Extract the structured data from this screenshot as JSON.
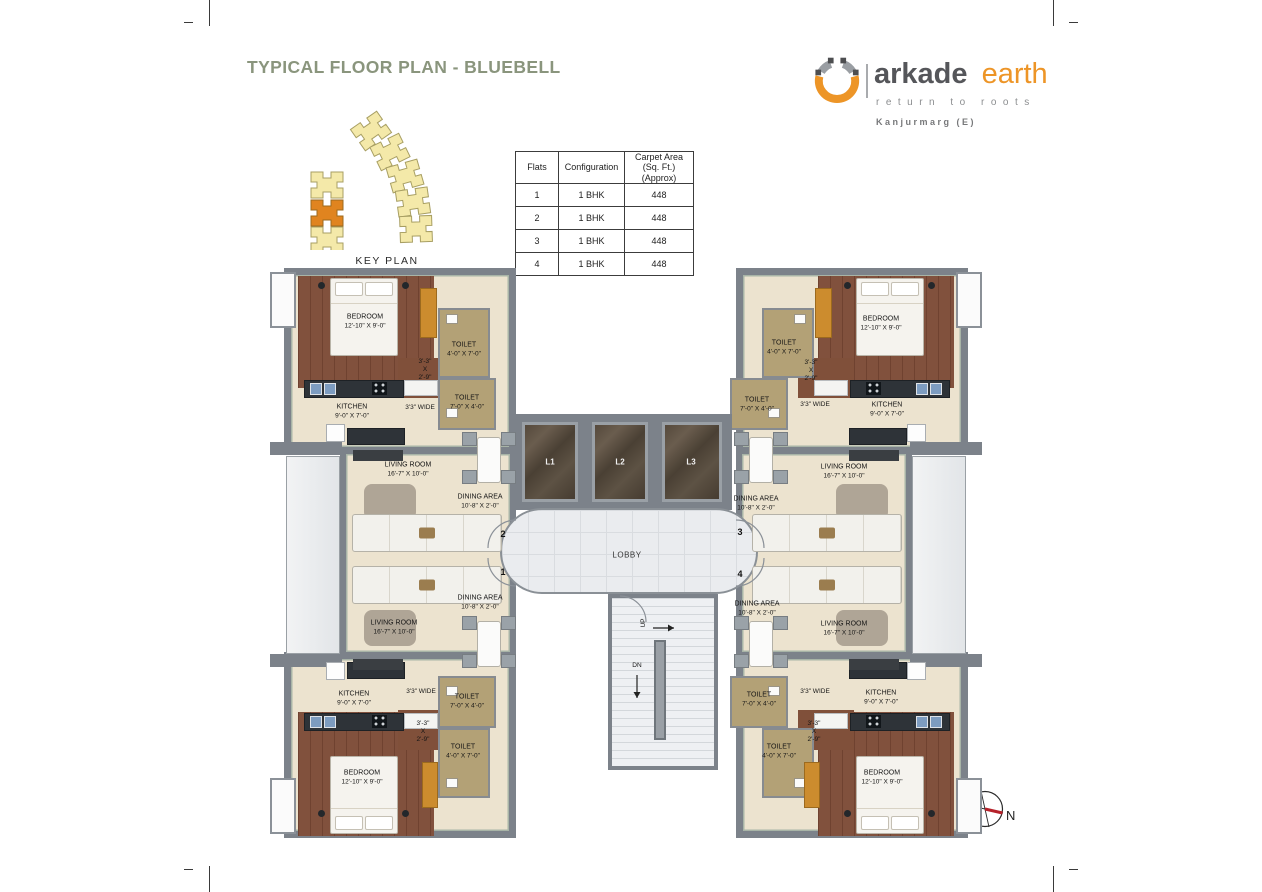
{
  "header": {
    "title": "TYPICAL FLOOR PLAN - BLUEBELL"
  },
  "logo": {
    "brand_primary": "arkade",
    "brand_secondary": "earth",
    "tagline": "return to roots",
    "location": "Kanjurmarg (E)"
  },
  "key_plan": {
    "label": "KEY PLAN"
  },
  "flats_table": {
    "headers": {
      "flats": "Flats",
      "configuration": "Configuration",
      "carpet_area_line1": "Carpet Area",
      "carpet_area_line2": "(Sq. Ft.) (Approx)"
    },
    "rows": [
      {
        "flat": "1",
        "config": "1 BHK",
        "area": "448"
      },
      {
        "flat": "2",
        "config": "1 BHK",
        "area": "448"
      },
      {
        "flat": "3",
        "config": "1 BHK",
        "area": "448"
      },
      {
        "flat": "4",
        "config": "1 BHK",
        "area": "448"
      }
    ]
  },
  "rooms": {
    "bedroom": {
      "name": "BEDROOM",
      "dim": "12'-10\" X 9'-0\""
    },
    "kitchen": {
      "name": "KITCHEN",
      "dim": "9'-0\" X 7'-0\""
    },
    "living_room": {
      "name": "LIVING ROOM",
      "dim": "16'-7\" X 10'-0\""
    },
    "dining_area": {
      "name": "DINING AREA",
      "dim": "10'-8\" X 2'-0\""
    },
    "toilet_v": {
      "name": "TOILET",
      "dim": "4'-0\" X 7'-0\""
    },
    "toilet_h": {
      "name": "TOILET",
      "dim": "7'-0\" X 4'-0\""
    },
    "passage": {
      "line1": "3'-3\"",
      "line2": "X",
      "line3": "2'-9\""
    },
    "corridor": {
      "dim": "3'3\" WIDE"
    }
  },
  "core": {
    "lifts": [
      "L1",
      "L2",
      "L3"
    ],
    "lobby": "LOBBY",
    "stair_up": "UP",
    "stair_down": "DN"
  },
  "flat_numbers": [
    "1",
    "2",
    "3",
    "4"
  ],
  "compass": {
    "north": "N"
  },
  "colors": {
    "title_green": "#8A957D",
    "accent_orange": "#ED9527",
    "wall_gray": "#7c828a",
    "bedroom_floor": "#7c4a35",
    "beige_floor": "#eae0cc",
    "toilet_floor": "#b3a176",
    "keyplan_yellow": "#f4e9a9",
    "keyplan_highlight": "#e0841f",
    "compass_needle": "#b5212a"
  }
}
